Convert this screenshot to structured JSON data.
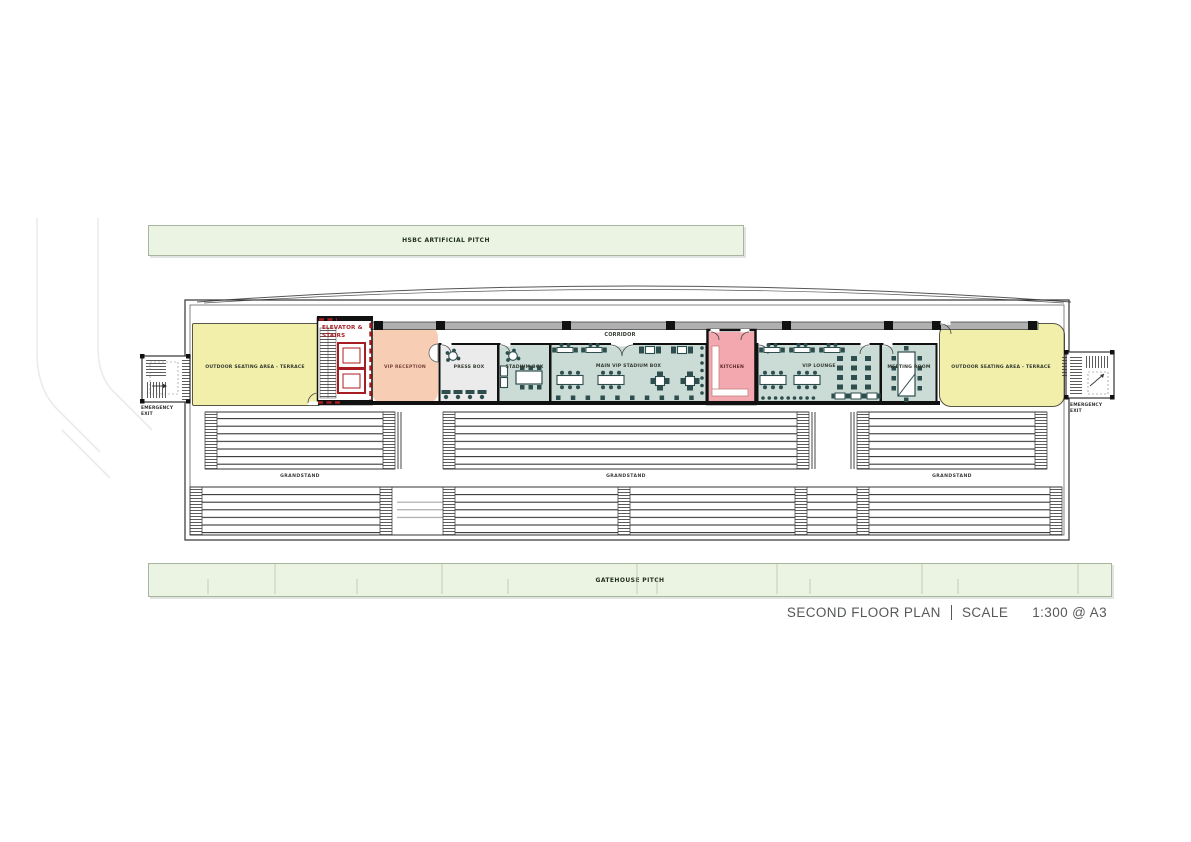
{
  "palette": {
    "pitch_green": "#ebf3e2",
    "terrace_yellow": "#f1efa9",
    "reception_peach": "#f7cdb4",
    "kitchen_pink": "#f3a7ae",
    "room_teal": "#cbdbd5",
    "pressbox_gray": "#ebebeb",
    "corridor_gray": "#b0b0b0",
    "furniture_teal": "#2e4d4d",
    "elevator_red": "#a81d22",
    "wall_black": "#111111",
    "title_gray": "#57585a"
  },
  "site": {
    "top_pitch": "HSBC ARTIFICIAL PITCH",
    "bottom_pitch": "GATEHOUSE PITCH"
  },
  "plan": {
    "corridor": "CORRIDOR",
    "rooms": {
      "terrace_left": "OUTDOOR SEATING AREA - TERRACE",
      "elevator_stairs": "ELEVATOR & STAIRS",
      "vip_reception": "VIP RECEPTION",
      "press_box": "PRESS BOX",
      "stadium_box": "STADIUM BOX",
      "main_vip": "MAIN VIP STADIUM BOX",
      "kitchen": "KITCHEN",
      "vip_lounge": "VIP LOUNGE",
      "meeting_room": "MEETING ROOM",
      "terrace_right": "OUTDOOR SEATING AREA - TERRACE"
    },
    "exits": {
      "left": "EMERGENCY EXIT",
      "right": "EMERGENCY EXIT"
    },
    "grandstands": [
      "GRANDSTAND",
      "GRANDSTAND",
      "GRANDSTAND"
    ]
  },
  "title_block": {
    "name": "SECOND FLOOR PLAN",
    "scale_label": "SCALE",
    "scale_value": "1:300 @ A3"
  }
}
